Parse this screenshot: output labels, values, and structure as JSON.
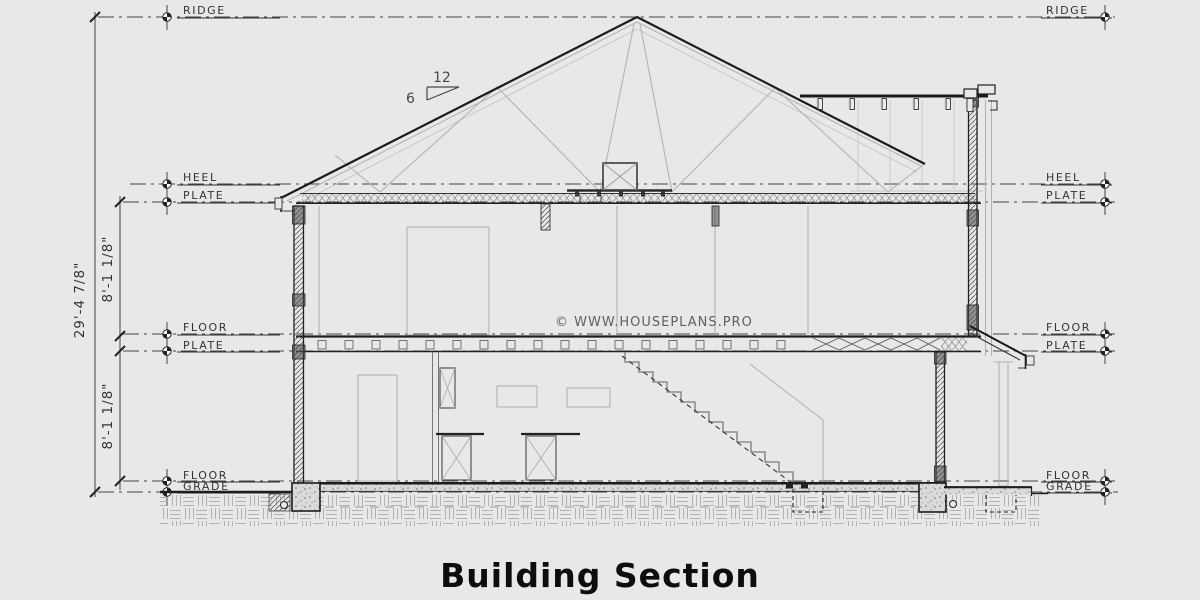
{
  "title": "Building Section",
  "watermark": "© WWW.HOUSEPLANS.PRO",
  "slope": {
    "run": "12",
    "rise": "6"
  },
  "dimensions": {
    "overall": "29'-4 7/8\"",
    "upper": "8'-1 1/8\"",
    "lower": "8'-1 1/8\""
  },
  "labels": {
    "ridge": "RIDGE",
    "heel": "HEEL",
    "plate": "PLATE",
    "floor": "FLOOR",
    "grade": "GRADE"
  },
  "colors": {
    "ink": "#222222",
    "light": "#b3b3b3",
    "paper": "#e8e8e8"
  }
}
